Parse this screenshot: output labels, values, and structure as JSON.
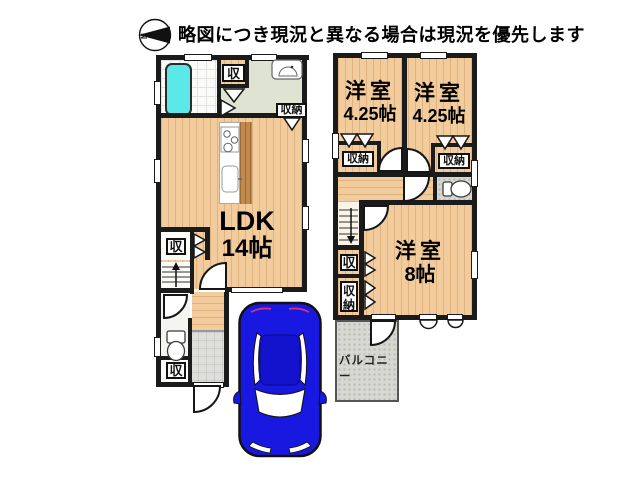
{
  "header": {
    "notice": "略図につき現況と異なる場合は現況を優先します",
    "compass_label": "N"
  },
  "floor1": {
    "ldk": {
      "name": "LDK",
      "size": "14帖"
    },
    "closet_top": "収",
    "closet_storage": "収納",
    "closet_mid": "収",
    "closet_toilet": "収"
  },
  "floor2": {
    "room_left": {
      "name": "洋室",
      "size": "4.25帖"
    },
    "room_right": {
      "name": "洋室",
      "size": "4.25帖"
    },
    "room_main": {
      "name": "洋室",
      "size": "8帖"
    },
    "closet_left": "収納",
    "closet_right": "収納",
    "closet_hall": "収",
    "closet_hall2": "収納",
    "balcony": "バルコニー"
  },
  "colors": {
    "wall": "#1B1B1B",
    "wood_floor": "#F2CC9C",
    "counter_wood": "#C08A4E",
    "bathtub_cyan": "#5CE8E8",
    "washroom_green": "#DFE4D2",
    "tile_gray": "#DEDEDA",
    "balcony_gray": "#D8D8D3",
    "car_blue": "#1818E0"
  }
}
